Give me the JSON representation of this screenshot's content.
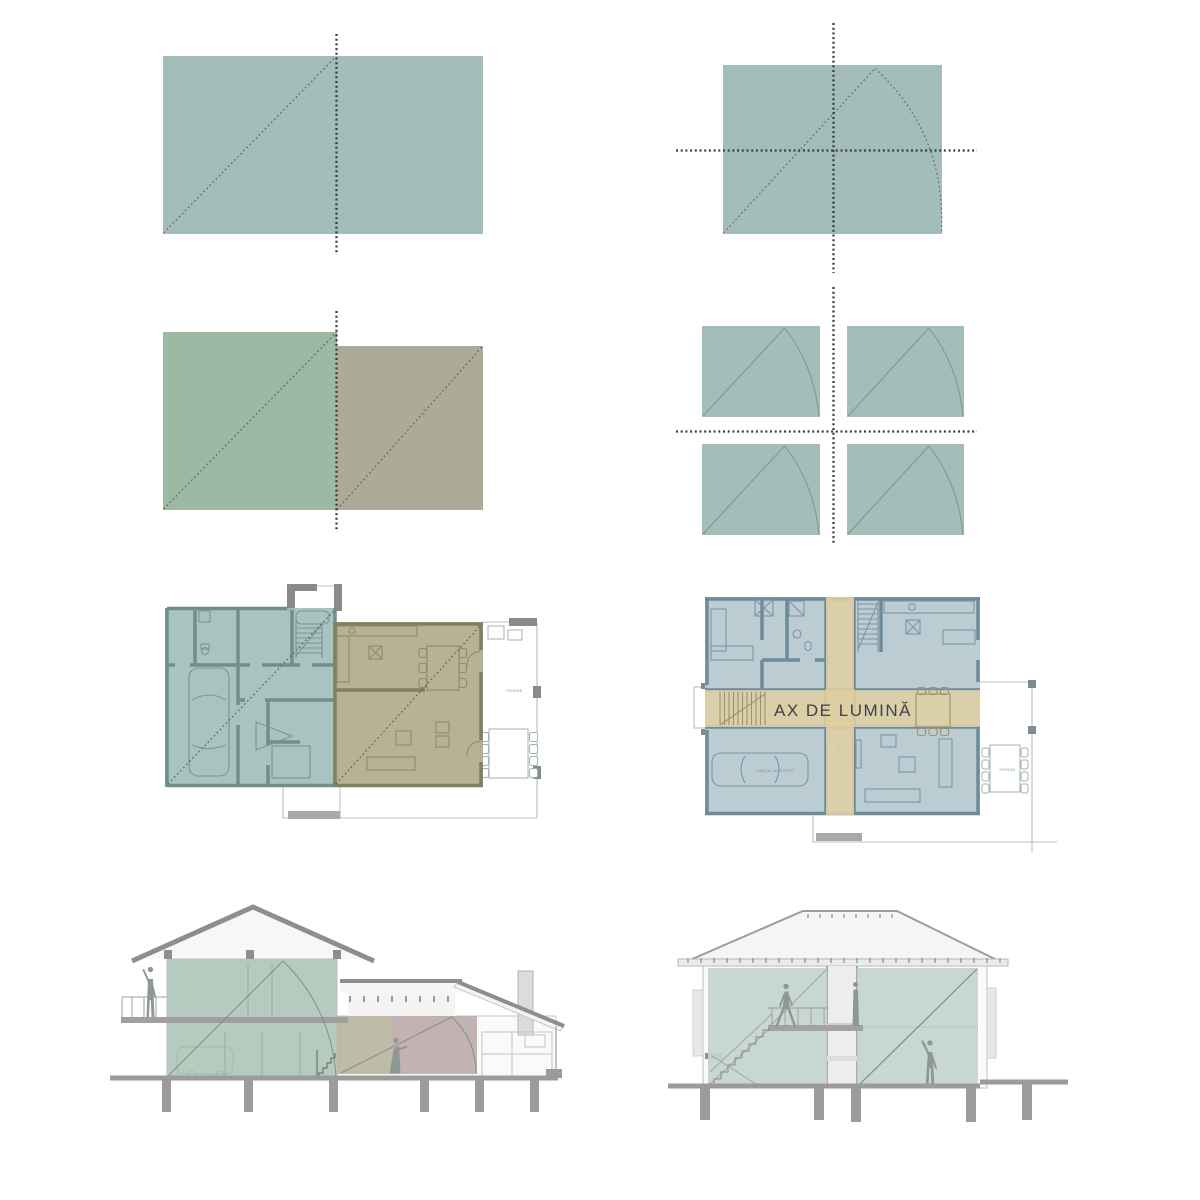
{
  "labels": {
    "axis_of_light": "AX DE LUMINĂ",
    "terrace": "TERASĂ",
    "covered_parking": "PARCAJ ACOPERIT"
  },
  "colors": {
    "teal": "#a3bdbb",
    "green": "#9bb9a3",
    "tan": "#adab97",
    "plan-teal": "#a2bfbb",
    "plan-tan": "#b1aa8d",
    "plan-blue": "#b8c9d0",
    "band-yellow": "#decfa2",
    "wall-teal": "#6e8f8b",
    "wall-tan": "#82805e",
    "wall-blue": "#6d8b9a",
    "section-green": "#aec5b8",
    "section-tan": "#b3b096",
    "section-red": "#b8a4a4",
    "section-teal": "#c5d4ce",
    "axis-dot": "#3c3c3c",
    "diag-dot": "#5d6662",
    "motif": "#7d8a86",
    "figure": "#8d9893",
    "ground": "#9b9b9b",
    "structure": "#8e8e8e",
    "text-dark": "#3f4347",
    "text-tiny": "#60798a",
    "furn-teal": "#789693",
    "furn-tan": "#8e8a6b",
    "furn-blue": "#7b96a4",
    "furn-band": "#9b9370",
    "outline-light": "#b9bfc0"
  }
}
